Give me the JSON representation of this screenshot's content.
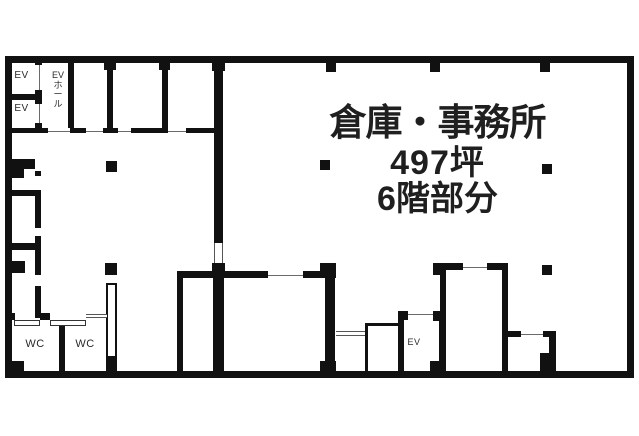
{
  "colors": {
    "wall": "#111111",
    "background": "#ffffff",
    "text": "#1f1f1f"
  },
  "title": {
    "line1": "倉庫・事務所",
    "line2": "497坪",
    "line3": "6階部分"
  },
  "labels": {
    "elevator_top_a": "EV",
    "elevator_top_b": "EV",
    "elevator_hall_lines": [
      "EV",
      "ホ",
      "ー",
      "ル"
    ],
    "wc_a": "WC",
    "wc_b": "WC",
    "elevator_bottom": "EV"
  },
  "floorplan": {
    "walls": [
      [
        5,
        56,
        629,
        7
      ],
      [
        5,
        371,
        629,
        7
      ],
      [
        5,
        56,
        7,
        322
      ],
      [
        627,
        56,
        7,
        322
      ],
      [
        35,
        62,
        7,
        3
      ],
      [
        35,
        90,
        7,
        14
      ],
      [
        35,
        123,
        7,
        10
      ],
      [
        8,
        94,
        27,
        6
      ],
      [
        68,
        62,
        6,
        66
      ],
      [
        104,
        62,
        12,
        8
      ],
      [
        107,
        70,
        6,
        58
      ],
      [
        159,
        62,
        11,
        8
      ],
      [
        162,
        70,
        6,
        58
      ],
      [
        212,
        62,
        13,
        9
      ],
      [
        214,
        71,
        9,
        172
      ],
      [
        212,
        263,
        13,
        15
      ],
      [
        8,
        128,
        40,
        5
      ],
      [
        70,
        128,
        16,
        5
      ],
      [
        103,
        128,
        15,
        5
      ],
      [
        131,
        128,
        37,
        5
      ],
      [
        186,
        128,
        28,
        5
      ],
      [
        12,
        159,
        23,
        10
      ],
      [
        12,
        169,
        12,
        9
      ],
      [
        35,
        171,
        6,
        5
      ],
      [
        35,
        190,
        6,
        38
      ],
      [
        35,
        236,
        6,
        39
      ],
      [
        35,
        286,
        6,
        32
      ],
      [
        12,
        190,
        23,
        6
      ],
      [
        12,
        243,
        23,
        7
      ],
      [
        12,
        261,
        13,
        12
      ],
      [
        12,
        313,
        3,
        7
      ],
      [
        40,
        313,
        10,
        7
      ],
      [
        59,
        326,
        6,
        46
      ],
      [
        5,
        361,
        19,
        17
      ],
      [
        106,
        358,
        11,
        14
      ],
      [
        177,
        271,
        6,
        107
      ],
      [
        183,
        271,
        85,
        7
      ],
      [
        303,
        271,
        22,
        7
      ],
      [
        213,
        271,
        11,
        107
      ],
      [
        320,
        263,
        16,
        15
      ],
      [
        325,
        278,
        10,
        83
      ],
      [
        320,
        361,
        16,
        17
      ],
      [
        365,
        323,
        35,
        3
      ],
      [
        365,
        323,
        3,
        49
      ],
      [
        398,
        311,
        6,
        61
      ],
      [
        398,
        311,
        10,
        9
      ],
      [
        433,
        311,
        12,
        10
      ],
      [
        439,
        317,
        6,
        55
      ],
      [
        430,
        361,
        15,
        12
      ],
      [
        433,
        263,
        13,
        12
      ],
      [
        440,
        263,
        6,
        109
      ],
      [
        446,
        263,
        17,
        7
      ],
      [
        487,
        263,
        21,
        7
      ],
      [
        502,
        263,
        6,
        108
      ],
      [
        508,
        331,
        13,
        6
      ],
      [
        543,
        331,
        13,
        6
      ],
      [
        549,
        337,
        7,
        26
      ],
      [
        540,
        353,
        16,
        18
      ]
    ],
    "pillars": [
      [
        326,
        63,
        10,
        9
      ],
      [
        430,
        63,
        10,
        9
      ],
      [
        540,
        63,
        10,
        9
      ],
      [
        106,
        161,
        11,
        11
      ],
      [
        320,
        160,
        10,
        10
      ],
      [
        542,
        164,
        10,
        10
      ],
      [
        105,
        263,
        12,
        12
      ],
      [
        542,
        265,
        10,
        10
      ]
    ],
    "partitions": [
      [
        106,
        283,
        11,
        75
      ]
    ],
    "doors": [
      {
        "style": "line-v",
        "x": 35,
        "y": 65,
        "w": 7,
        "h": 25
      },
      {
        "style": "line-v",
        "x": 35,
        "y": 104,
        "w": 7,
        "h": 19
      },
      {
        "style": "line-h",
        "x": 48,
        "y": 128,
        "w": 22,
        "h": 5
      },
      {
        "style": "line-h",
        "x": 86,
        "y": 128,
        "w": 17,
        "h": 5
      },
      {
        "style": "line-h",
        "x": 118,
        "y": 128,
        "w": 13,
        "h": 5
      },
      {
        "style": "line-h",
        "x": 168,
        "y": 128,
        "w": 18,
        "h": 5
      },
      {
        "style": "double-v",
        "x": 214,
        "y": 243,
        "w": 9,
        "h": 20
      },
      {
        "style": "double-h",
        "x": 86,
        "y": 314,
        "w": 21,
        "h": 4
      },
      {
        "style": "rect",
        "x": 14,
        "y": 320,
        "w": 26,
        "h": 6
      },
      {
        "style": "rect",
        "x": 50,
        "y": 320,
        "w": 36,
        "h": 6
      },
      {
        "style": "line-h",
        "x": 268,
        "y": 271,
        "w": 35,
        "h": 7
      },
      {
        "style": "double-h",
        "x": 336,
        "y": 331,
        "w": 29,
        "h": 5
      },
      {
        "style": "line-h",
        "x": 408,
        "y": 311,
        "w": 25,
        "h": 6
      },
      {
        "style": "line-h",
        "x": 463,
        "y": 263,
        "w": 24,
        "h": 7
      },
      {
        "style": "line-h",
        "x": 521,
        "y": 331,
        "w": 22,
        "h": 6
      }
    ]
  }
}
